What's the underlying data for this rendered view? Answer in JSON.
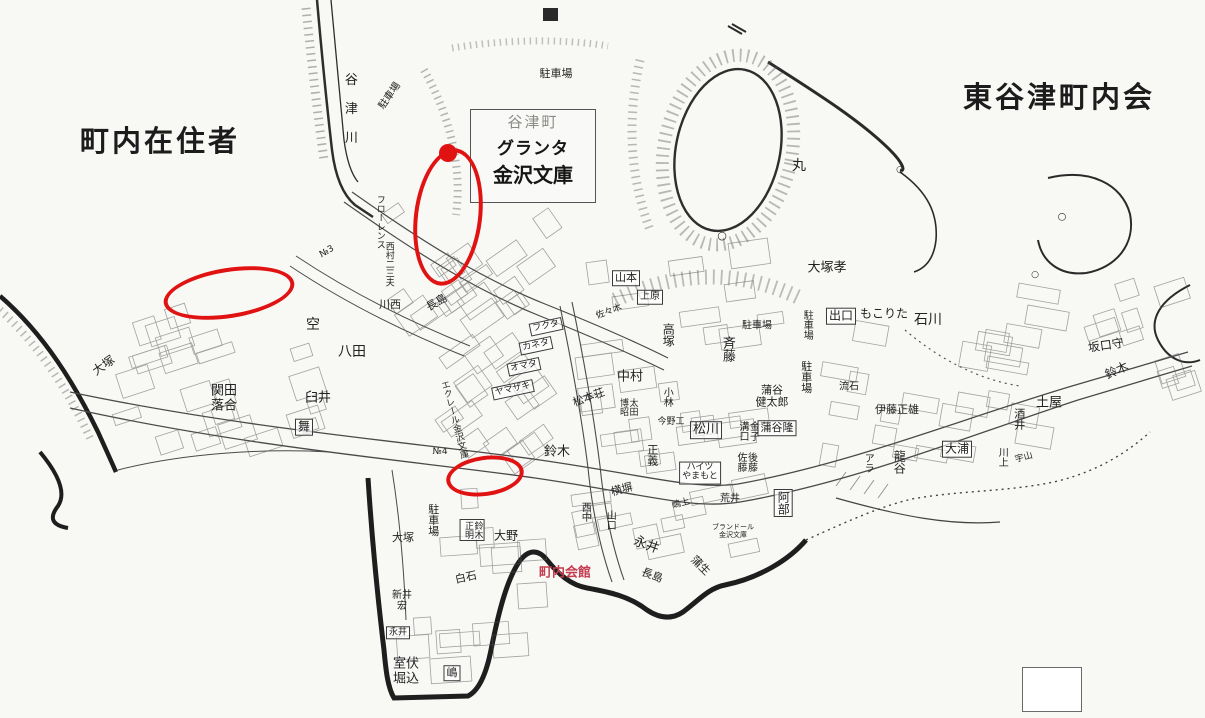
{
  "palette": {
    "paper": "#f8f8f5",
    "ink": "#3a3a3a",
    "annotation_red": "#e01212",
    "red_text": "#c43b4e",
    "faint": "#8a8a86"
  },
  "titles": {
    "left": "町内在住者",
    "right": "東谷津町内会"
  },
  "landmark": {
    "district": "谷津町",
    "line1": "グランタ",
    "line2": "金沢文庫"
  },
  "map": {
    "labels": [
      {
        "name": "river-label",
        "text": "谷津川",
        "x": 349,
        "y": 116,
        "size": 13,
        "vertical": true,
        "spacing": 16
      },
      {
        "name": "parking-lot-label",
        "text": "駐車場",
        "x": 390,
        "y": 96,
        "size": 10,
        "rotate": -55
      },
      {
        "name": "parking-lot-label",
        "text": "駐車場",
        "x": 556,
        "y": 74,
        "size": 11
      },
      {
        "name": "maru-label",
        "text": "丸",
        "x": 799,
        "y": 167,
        "size": 14
      },
      {
        "name": "circle-marker",
        "text": "○",
        "x": 722,
        "y": 236,
        "size": 11
      },
      {
        "name": "circle-marker",
        "text": "○",
        "x": 900,
        "y": 170,
        "size": 9
      },
      {
        "name": "circle-marker",
        "text": "○",
        "x": 1062,
        "y": 217,
        "size": 10
      },
      {
        "name": "circle-marker",
        "text": "○",
        "x": 1035,
        "y": 275,
        "size": 9
      },
      {
        "name": "resident-label",
        "text": "大塚",
        "x": 104,
        "y": 366,
        "size": 12,
        "rotate": -35
      },
      {
        "name": "resident-label",
        "text": "関田\n落合",
        "x": 224,
        "y": 399,
        "size": 13
      },
      {
        "name": "area-label",
        "text": "空",
        "x": 313,
        "y": 326,
        "size": 14
      },
      {
        "name": "resident-label",
        "text": "八田",
        "x": 352,
        "y": 353,
        "size": 14
      },
      {
        "name": "resident-label",
        "text": "臼井",
        "x": 318,
        "y": 399,
        "size": 13
      },
      {
        "name": "resident-label",
        "text": "舞",
        "x": 304,
        "y": 427,
        "size": 12,
        "boxed": true
      },
      {
        "name": "resident-label",
        "text": "川西",
        "x": 390,
        "y": 305,
        "size": 11
      },
      {
        "name": "resident-label",
        "text": "西村二三夫",
        "x": 388,
        "y": 264,
        "size": 9,
        "vertical": true
      },
      {
        "name": "building-label",
        "text": "フローレンス",
        "x": 379,
        "y": 222,
        "size": 9,
        "vertical": true
      },
      {
        "name": "block-number",
        "text": "№3",
        "x": 327,
        "y": 252,
        "size": 9,
        "rotate": -30
      },
      {
        "name": "block-number",
        "text": "№4",
        "x": 440,
        "y": 452,
        "size": 9
      },
      {
        "name": "resident-label",
        "text": "長島",
        "x": 437,
        "y": 303,
        "size": 11,
        "rotate": -30
      },
      {
        "name": "shop-label",
        "text": "フクタ",
        "x": 546,
        "y": 327,
        "size": 9,
        "boxed": true,
        "rotate": -12
      },
      {
        "name": "shop-label",
        "text": "カネタ",
        "x": 536,
        "y": 346,
        "size": 9,
        "boxed": true,
        "rotate": -12
      },
      {
        "name": "shop-label",
        "text": "オマタ",
        "x": 524,
        "y": 367,
        "size": 9,
        "boxed": true,
        "rotate": -12
      },
      {
        "name": "shop-label",
        "text": "ヤマザキ",
        "x": 513,
        "y": 390,
        "size": 9,
        "boxed": true,
        "rotate": -12
      },
      {
        "name": "building-label",
        "text": "エクレール金沢文庫",
        "x": 453,
        "y": 420,
        "size": 9,
        "vertical": true,
        "rotate": -15
      },
      {
        "name": "resident-label",
        "text": "山本",
        "x": 626,
        "y": 278,
        "size": 11,
        "boxed": true
      },
      {
        "name": "resident-label",
        "text": "上原",
        "x": 650,
        "y": 297,
        "size": 10,
        "boxed": true
      },
      {
        "name": "resident-label",
        "text": "佐々木",
        "x": 609,
        "y": 312,
        "size": 9,
        "rotate": -20
      },
      {
        "name": "resident-label",
        "text": "高塚",
        "x": 668,
        "y": 335,
        "size": 12,
        "vertical": true
      },
      {
        "name": "resident-label",
        "text": "斉藤",
        "x": 727,
        "y": 349,
        "size": 13,
        "vertical": true
      },
      {
        "name": "parking-lot-label",
        "text": "駐車場",
        "x": 757,
        "y": 326,
        "size": 10
      },
      {
        "name": "parking-lot-label",
        "text": "駐車場",
        "x": 806,
        "y": 325,
        "size": 10,
        "vertical": true
      },
      {
        "name": "parking-lot-label",
        "text": "駐車場",
        "x": 806,
        "y": 377,
        "size": 11,
        "vertical": true
      },
      {
        "name": "resident-label",
        "text": "中村",
        "x": 630,
        "y": 378,
        "size": 13
      },
      {
        "name": "building-label",
        "text": "松本荘",
        "x": 589,
        "y": 398,
        "size": 11,
        "rotate": -20
      },
      {
        "name": "resident-label",
        "text": "太田\n博昭",
        "x": 627,
        "y": 407,
        "size": 9,
        "vertical": true
      },
      {
        "name": "resident-label",
        "text": "小林",
        "x": 666,
        "y": 397,
        "size": 10,
        "vertical": true
      },
      {
        "name": "resident-label",
        "text": "今野工",
        "x": 671,
        "y": 422,
        "size": 9
      },
      {
        "name": "resident-label",
        "text": "正義",
        "x": 652,
        "y": 455,
        "size": 11,
        "vertical": true
      },
      {
        "name": "resident-label",
        "text": "松川",
        "x": 706,
        "y": 430,
        "size": 13,
        "boxed": true
      },
      {
        "name": "resident-label",
        "text": "金子\n溝口",
        "x": 747,
        "y": 431,
        "size": 10,
        "vertical": true
      },
      {
        "name": "resident-label",
        "text": "蒲谷\n健太郎",
        "x": 772,
        "y": 397,
        "size": 11
      },
      {
        "name": "resident-label",
        "text": "蒲谷隆",
        "x": 777,
        "y": 428,
        "size": 11,
        "boxed": true
      },
      {
        "name": "resident-label",
        "text": "後藤\n佐藤",
        "x": 745,
        "y": 462,
        "size": 10,
        "vertical": true
      },
      {
        "name": "building-label",
        "text": "ハイツ\nやまもと",
        "x": 700,
        "y": 473,
        "size": 9,
        "boxed": true
      },
      {
        "name": "resident-label",
        "text": "荒井",
        "x": 730,
        "y": 499,
        "size": 10
      },
      {
        "name": "resident-label",
        "text": "阿部",
        "x": 783,
        "y": 503,
        "size": 12,
        "vertical": true,
        "boxed": true
      },
      {
        "name": "building-label",
        "text": "ブランドール\n金沢文庫",
        "x": 733,
        "y": 532,
        "size": 7
      },
      {
        "name": "resident-label",
        "text": "鈴木",
        "x": 557,
        "y": 453,
        "size": 13
      },
      {
        "name": "resident-label",
        "text": "横塀",
        "x": 622,
        "y": 490,
        "size": 11,
        "rotate": -15
      },
      {
        "name": "resident-label",
        "text": "嶋上",
        "x": 681,
        "y": 504,
        "size": 9,
        "rotate": -15
      },
      {
        "name": "resident-label",
        "text": "西中",
        "x": 584,
        "y": 512,
        "size": 10,
        "vertical": true
      },
      {
        "name": "resident-label",
        "text": "山口",
        "x": 609,
        "y": 520,
        "size": 10,
        "vertical": true
      },
      {
        "name": "resident-label",
        "text": "大塚孝",
        "x": 827,
        "y": 269,
        "size": 13
      },
      {
        "name": "resident-label",
        "text": "出口",
        "x": 841,
        "y": 316,
        "size": 12,
        "boxed": true
      },
      {
        "name": "resident-label",
        "text": "もこりた",
        "x": 884,
        "y": 314,
        "size": 12
      },
      {
        "name": "resident-label",
        "text": "石川",
        "x": 928,
        "y": 321,
        "size": 14
      },
      {
        "name": "resident-label",
        "text": "流石",
        "x": 849,
        "y": 387,
        "size": 10
      },
      {
        "name": "resident-label",
        "text": "伊藤正雄",
        "x": 897,
        "y": 410,
        "size": 11
      },
      {
        "name": "resident-label",
        "text": "坂口守",
        "x": 1106,
        "y": 346,
        "size": 12,
        "rotate": -8
      },
      {
        "name": "resident-label",
        "text": "鈴木",
        "x": 1117,
        "y": 371,
        "size": 12,
        "rotate": -25
      },
      {
        "name": "resident-label",
        "text": "土屋",
        "x": 1049,
        "y": 404,
        "size": 13
      },
      {
        "name": "resident-label",
        "text": "酒井",
        "x": 1019,
        "y": 419,
        "size": 11,
        "vertical": true
      },
      {
        "name": "resident-label",
        "text": "大浦",
        "x": 957,
        "y": 449,
        "size": 12,
        "boxed": true
      },
      {
        "name": "resident-label",
        "text": "アラ",
        "x": 867,
        "y": 463,
        "size": 10,
        "vertical": true
      },
      {
        "name": "resident-label",
        "text": "龍谷",
        "x": 899,
        "y": 462,
        "size": 12,
        "vertical": true
      },
      {
        "name": "resident-label",
        "text": "川上",
        "x": 1001,
        "y": 457,
        "size": 10,
        "vertical": true
      },
      {
        "name": "resident-label",
        "text": "宇山",
        "x": 1024,
        "y": 458,
        "size": 9,
        "rotate": -15
      },
      {
        "name": "parking-lot-label",
        "text": "駐車場",
        "x": 433,
        "y": 520,
        "size": 11,
        "vertical": true
      },
      {
        "name": "resident-label",
        "text": "大塚",
        "x": 403,
        "y": 538,
        "size": 11
      },
      {
        "name": "resident-label",
        "text": "鈴木\n正明",
        "x": 472,
        "y": 530,
        "size": 9,
        "vertical": true,
        "boxed": true
      },
      {
        "name": "resident-label",
        "text": "大野",
        "x": 506,
        "y": 536,
        "size": 12
      },
      {
        "name": "resident-label",
        "text": "白石",
        "x": 466,
        "y": 578,
        "size": 11,
        "rotate": -12
      },
      {
        "name": "town-hall-label",
        "text": "町内会館",
        "x": 565,
        "y": 574,
        "size": 13,
        "bold": true,
        "color": "#c43b4e"
      },
      {
        "name": "resident-label",
        "text": "新井\n宏",
        "x": 402,
        "y": 601,
        "size": 10
      },
      {
        "name": "resident-label",
        "text": "永井",
        "x": 398,
        "y": 633,
        "size": 9,
        "boxed": true
      },
      {
        "name": "resident-label",
        "text": "室伏\n堀込",
        "x": 406,
        "y": 672,
        "size": 13
      },
      {
        "name": "resident-label",
        "text": "嶋",
        "x": 452,
        "y": 673,
        "size": 11,
        "boxed": true
      },
      {
        "name": "resident-label",
        "text": "永井",
        "x": 646,
        "y": 546,
        "size": 13,
        "rotate": 20
      },
      {
        "name": "resident-label",
        "text": "長島",
        "x": 652,
        "y": 576,
        "size": 11,
        "rotate": 20
      },
      {
        "name": "resident-label",
        "text": "蒲生",
        "x": 700,
        "y": 566,
        "size": 11,
        "rotate": 45
      }
    ],
    "annotations": {
      "ellipses": [
        {
          "name": "highlight-ellipse-1",
          "cx": 225,
          "cy": 289,
          "rx": 62,
          "ry": 21,
          "rotate": -9
        },
        {
          "name": "highlight-ellipse-2",
          "cx": 444,
          "cy": 213,
          "rx": 30,
          "ry": 65,
          "rotate": 7
        },
        {
          "name": "highlight-ellipse-3",
          "cx": 481,
          "cy": 472,
          "rx": 35,
          "ry": 16,
          "rotate": -8
        }
      ],
      "dots": [
        {
          "name": "highlight-dot",
          "cx": 448,
          "cy": 153,
          "r": 9
        }
      ]
    }
  }
}
